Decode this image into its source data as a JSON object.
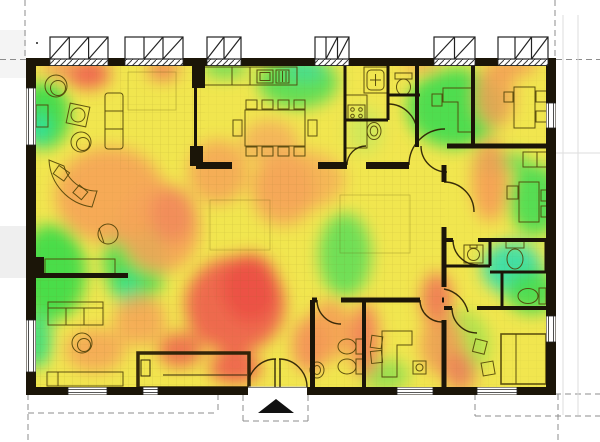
{
  "canvas": {
    "width": 600,
    "height": 442,
    "background": "#ffffff"
  },
  "palette": {
    "heat_base": "#f1e64f",
    "heat_green": "#46dc50",
    "heat_cyan": "#32dfae",
    "heat_yellow_green": "#a0e24e",
    "heat_orange": "#f6a458",
    "heat_red": "#ee5c4d",
    "heat_deep_red": "#ec5046",
    "wall": "#1b1508",
    "furniture_line": "#50420a",
    "grid_line": "#7a6a1a",
    "guide_dash": "#8c8c8c",
    "marker": "#111111"
  },
  "chart_data": {
    "type": "heatmap",
    "title": "",
    "description_visible_text": "",
    "blur": 8,
    "blobs": [
      [
        44,
        115,
        26,
        34,
        "#3fdb4b",
        0.95
      ],
      [
        38,
        128,
        13,
        16,
        "#2fe0a0",
        0.9
      ],
      [
        52,
        272,
        34,
        48,
        "#42dc4a",
        0.95
      ],
      [
        36,
        340,
        16,
        28,
        "#38df7e",
        0.9
      ],
      [
        135,
        260,
        32,
        46,
        "#4fdd52",
        0.95
      ],
      [
        128,
        290,
        13,
        18,
        "#35e08c",
        0.9
      ],
      [
        298,
        82,
        40,
        26,
        "#5bdd55",
        0.95
      ],
      [
        305,
        70,
        20,
        11,
        "#3ede9a",
        0.85
      ],
      [
        225,
        68,
        22,
        10,
        "#66dd55",
        0.9
      ],
      [
        455,
        108,
        48,
        40,
        "#46dc50",
        0.95
      ],
      [
        500,
        162,
        28,
        11,
        "#55dd55",
        0.9
      ],
      [
        535,
        200,
        26,
        36,
        "#4fdd52",
        0.95
      ],
      [
        512,
        268,
        30,
        26,
        "#32dfae",
        0.9
      ],
      [
        532,
        292,
        26,
        22,
        "#46dc50",
        0.9
      ],
      [
        345,
        255,
        26,
        42,
        "#62de58",
        0.9
      ],
      [
        385,
        375,
        24,
        16,
        "#8ade50",
        0.85
      ],
      [
        460,
        345,
        30,
        35,
        "#a0e24e",
        0.8
      ],
      [
        365,
        130,
        18,
        24,
        "#c8e85c",
        0.8
      ],
      [
        110,
        195,
        55,
        48,
        "#f6a458",
        0.9
      ],
      [
        160,
        228,
        40,
        45,
        "#f6a458",
        0.9
      ],
      [
        172,
        215,
        22,
        28,
        "#f28a5c",
        0.85
      ],
      [
        218,
        172,
        30,
        32,
        "#f6a458",
        0.85
      ],
      [
        283,
        190,
        32,
        36,
        "#f6a458",
        0.85
      ],
      [
        300,
        180,
        45,
        30,
        "#f6a458",
        0.7
      ],
      [
        270,
        142,
        28,
        22,
        "#f5ab5c",
        0.8
      ],
      [
        140,
        320,
        26,
        26,
        "#f6a458",
        0.85
      ],
      [
        95,
        350,
        30,
        22,
        "#f6a458",
        0.85
      ],
      [
        88,
        74,
        22,
        15,
        "#ef6450",
        0.95
      ],
      [
        60,
        68,
        18,
        10,
        "#f4935a",
        0.85
      ],
      [
        163,
        70,
        16,
        11,
        "#f08255",
        0.9
      ],
      [
        235,
        305,
        50,
        48,
        "#ee5c4d",
        0.9
      ],
      [
        250,
        288,
        28,
        34,
        "#ec5046",
        0.95
      ],
      [
        180,
        350,
        22,
        18,
        "#ef6450",
        0.85
      ],
      [
        235,
        368,
        26,
        16,
        "#ee5c4d",
        0.9
      ],
      [
        310,
        345,
        18,
        28,
        "#f4885a",
        0.85
      ],
      [
        330,
        330,
        22,
        30,
        "#f59b55",
        0.85
      ],
      [
        365,
        340,
        14,
        38,
        "#f2775a",
        0.85
      ],
      [
        490,
        180,
        18,
        42,
        "#f69d55",
        0.9
      ],
      [
        495,
        95,
        20,
        33,
        "#f5a055",
        0.85
      ],
      [
        515,
        66,
        22,
        10,
        "#f49a56",
        0.85
      ],
      [
        420,
        64,
        20,
        8,
        "#f5a055",
        0.8
      ],
      [
        437,
        300,
        16,
        28,
        "#f07055",
        0.85
      ],
      [
        442,
        345,
        22,
        30,
        "#f59b55",
        0.85
      ],
      [
        460,
        372,
        16,
        20,
        "#f2775a",
        0.8
      ]
    ]
  },
  "entrance_marker": {
    "shape": "triangle-up",
    "color": "#111111"
  }
}
